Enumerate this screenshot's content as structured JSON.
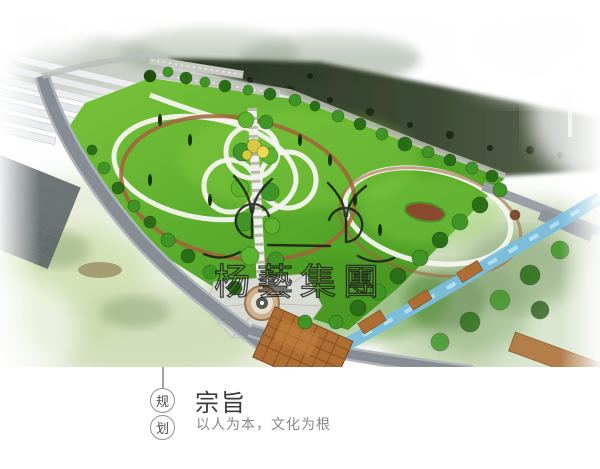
{
  "hero": {
    "description": "公园总体规划鸟瞰效果图",
    "watermark": {
      "logo": "yangyi-group-logo",
      "text": "杨藝集團"
    },
    "palette": {
      "lawn": "#56a82a",
      "water": "#79bedd",
      "road": "#868d95",
      "boardwalk": "#ad6d33",
      "forest": "#2b3824"
    }
  },
  "caption": {
    "badges": [
      "规",
      "划"
    ],
    "title": "宗旨",
    "subtitle": "以人为本，文化为根"
  }
}
